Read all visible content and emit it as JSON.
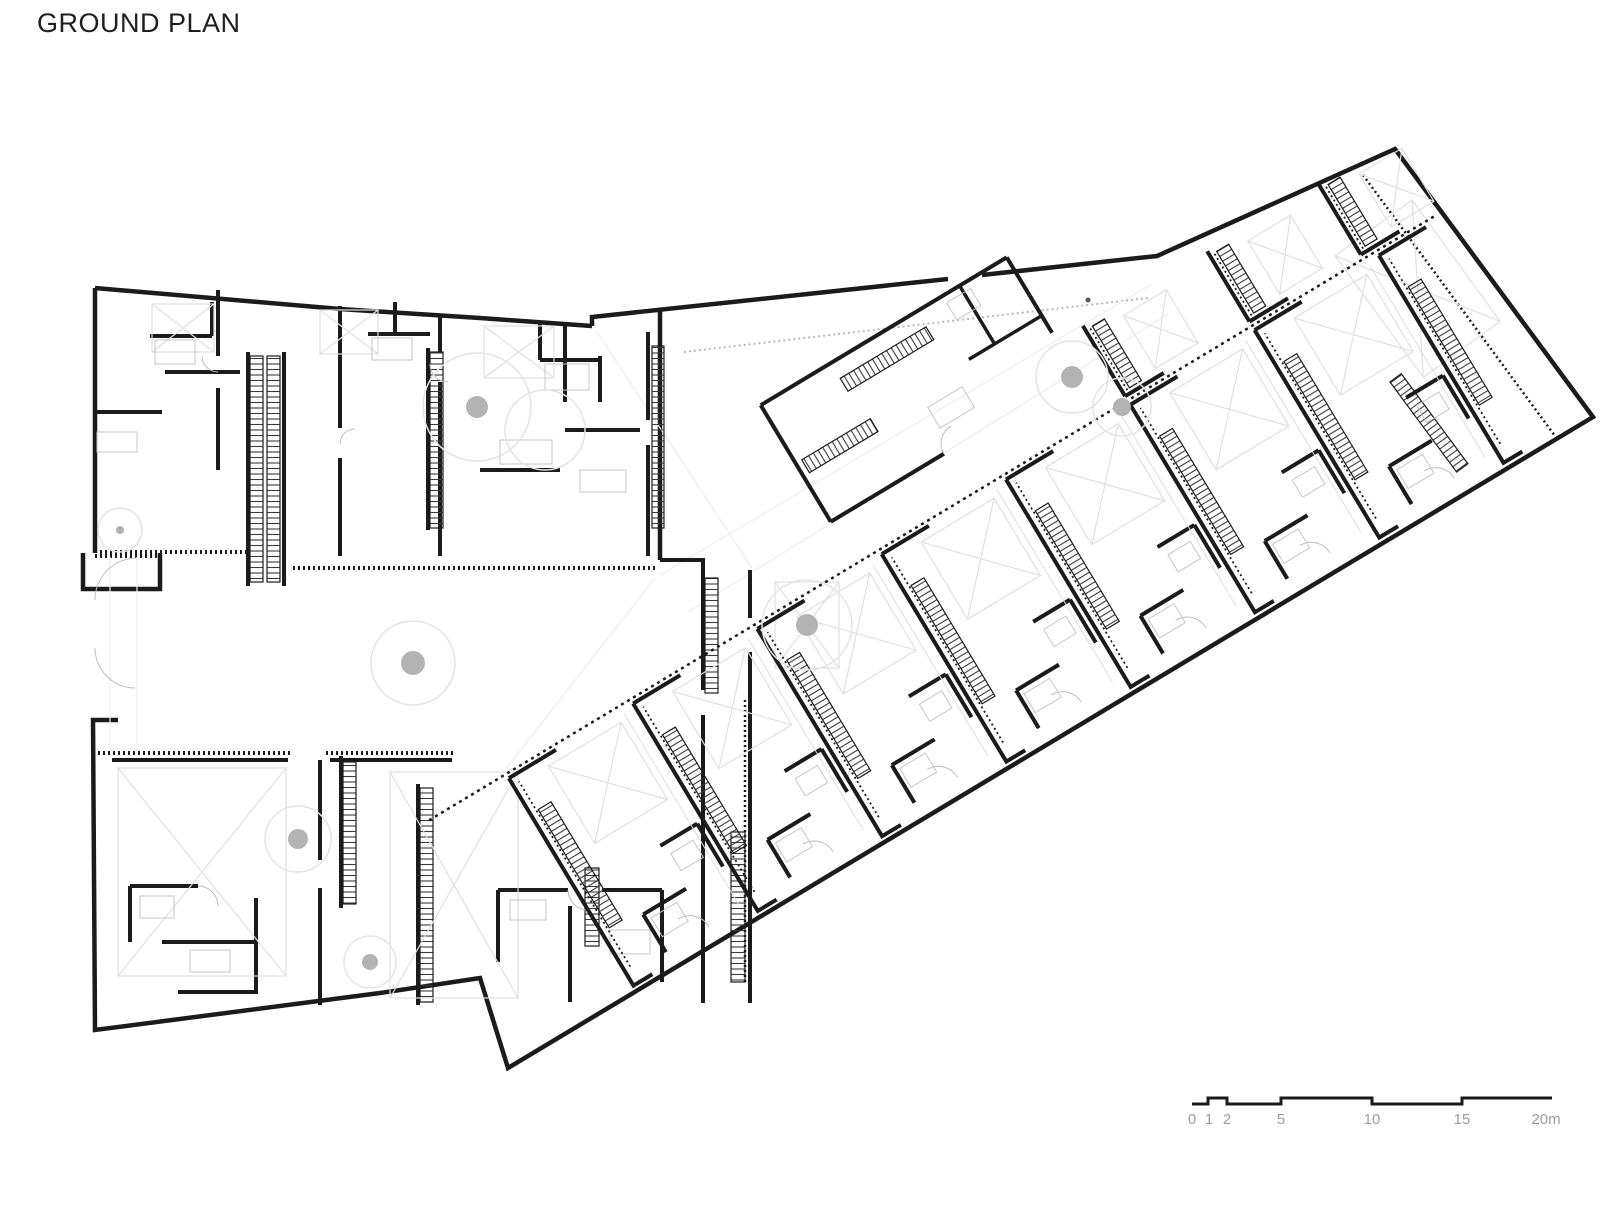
{
  "page": {
    "background": "#ffffff"
  },
  "title": "GROUND PLAN",
  "plan": {
    "type": "architectural-ground-floor-plan",
    "wall_color": "#1b1b1b",
    "thin_detail_color": "#c6c6c6",
    "faint_detail_color": "#ededed",
    "void_x_color": "#e0e0e0",
    "arc_color": "#bdbdbd",
    "tree_dot_color": "#b3b3b3",
    "tree_ring_color": "#e4e4e4",
    "dotted_band_color": "#1b1b1b"
  },
  "scalebar": {
    "labels": [
      "0",
      "1",
      "2",
      "5",
      "10",
      "15",
      "20m"
    ],
    "unit": "m",
    "label_color": "#9c9c9c",
    "bar_color": "#1b1b1b"
  }
}
